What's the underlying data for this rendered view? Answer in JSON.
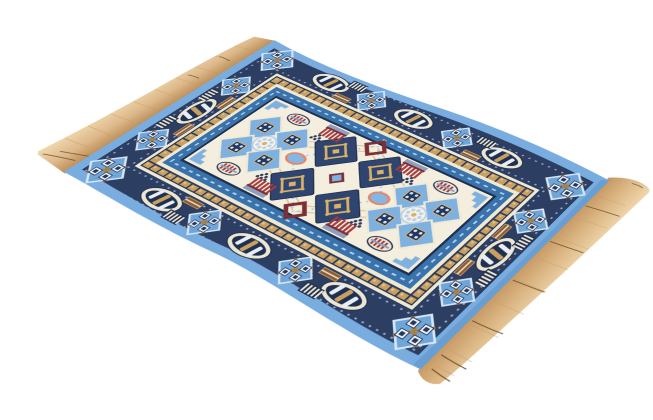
{
  "image": {
    "alt": "Flying magic carpet illustration seen in perspective, rippling as if in flight, with tasseled tan fringe on both ends",
    "style": "flat vector clipart",
    "background": "plain white / transparent"
  },
  "palette": {
    "skyBlue": "#79ade0",
    "navy": "#2c3e62",
    "navyDeep": "#20304f",
    "periwinkle": "#93a7d3",
    "cream": "#efe8d3",
    "field": "#f3eedd",
    "gold": "#c9a061",
    "goldLight": "#e2c38b",
    "goldDark": "#8a6b3e",
    "steelBlue": "#3a73ab",
    "iceBlue": "#a9cdec",
    "motifBlue": "#7fb1e0",
    "diamondNavy": "#2f4570",
    "brickRed": "#a63c3f",
    "maroon": "#7b2f37",
    "salmon": "#dd8a72",
    "brown": "#8a5a38",
    "fringeLight": "#f0d9ae",
    "fringeMid": "#ddb88a",
    "fringeDark": "#b98c55",
    "fringeCrease": "#6b4a22"
  },
  "carpet": {
    "layers": [
      "left end fringe",
      "right end fringe",
      "sky blue outer band",
      "navy ornamental border",
      "periwinkle bead rows",
      "cream band",
      "gold checkered ribbon",
      "steel blue frame with bead dashes",
      "cream central field"
    ],
    "border_motifs": [
      "oval cartouche with slanted bars",
      "stepped diamond medallion with gold cross",
      "white striped block",
      "brown bar block"
    ],
    "field_motifs": [
      "2x2 cluster of navy diamonds with gold inner squares",
      "maroon diamond rings",
      "light blue diamonds holding dotted navy squares",
      "lace rosette medallions",
      "red comb motifs",
      "striped ovals",
      "salmon-ringed blue ellipses",
      "grape dot clusters",
      "stepped corner triangles",
      "tan lattice lines"
    ],
    "fringe_sides": [
      "upper-left short end",
      "lower-right short end"
    ]
  }
}
